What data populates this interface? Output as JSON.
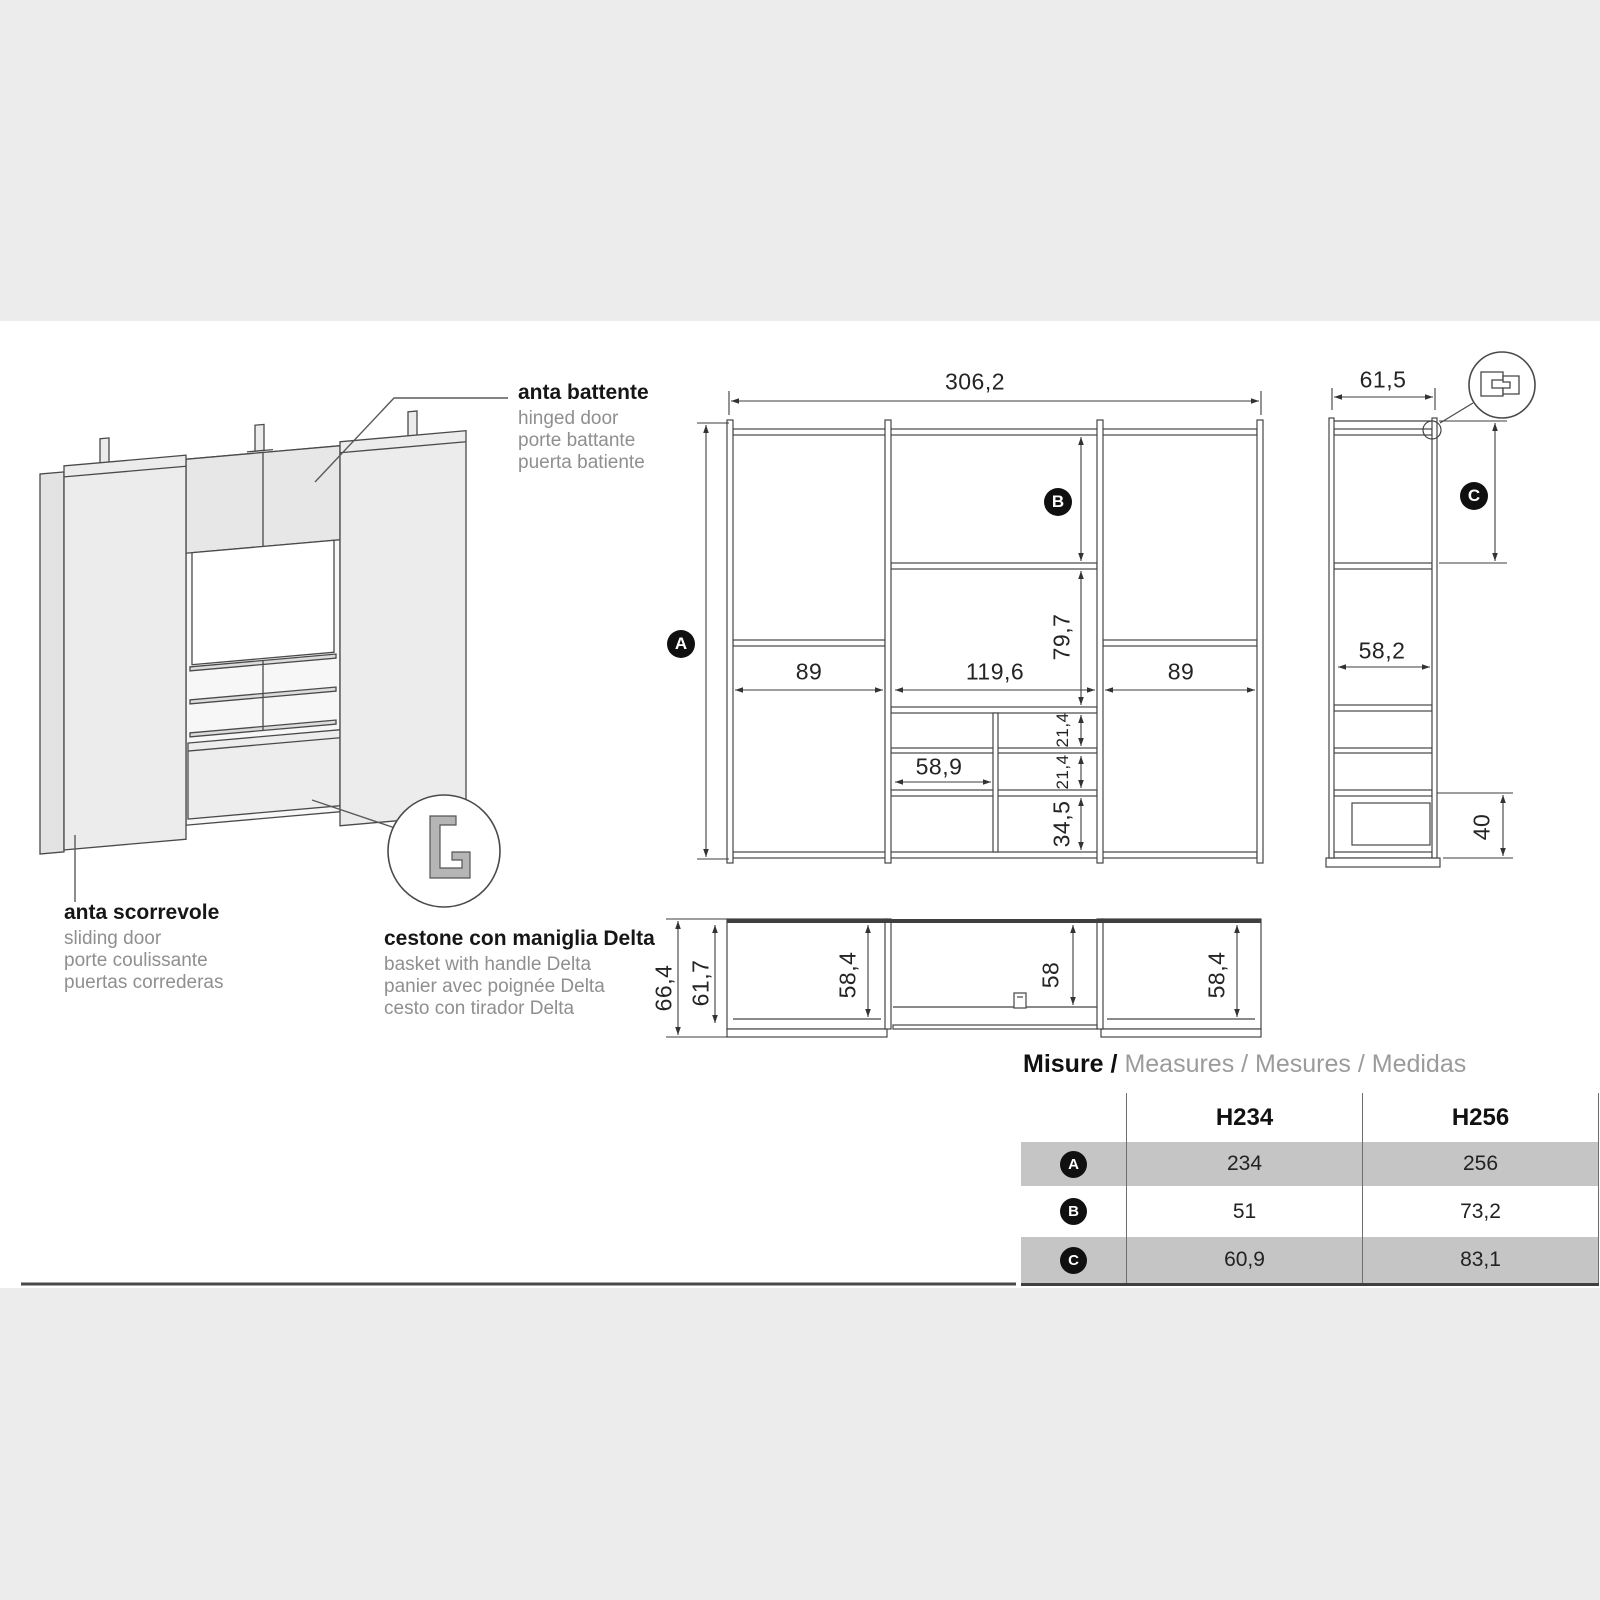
{
  "annotations": {
    "hinged_door": {
      "title": "anta battente",
      "translations": [
        "hinged door",
        "porte battante",
        "puerta batiente"
      ]
    },
    "sliding_door": {
      "title": "anta scorrevole",
      "translations": [
        "sliding door",
        "porte coulissante",
        "puertas correderas"
      ]
    },
    "basket": {
      "title": "cestone con maniglia Delta",
      "translations": [
        "basket with handle Delta",
        "panier avec poignée Delta",
        "cesto con tirador Delta"
      ]
    }
  },
  "front_view": {
    "total_width": "306,2",
    "height_marker": "A",
    "upper_marker": "B",
    "left_width": "89",
    "middle_width": "119,6",
    "right_width": "89",
    "middle_height": "79,7",
    "shelf_gap_1": "21,4",
    "shelf_gap_2": "21,4",
    "bottom_height": "34,5",
    "basket_width": "58,9"
  },
  "side_view": {
    "total_depth": "61,5",
    "depth_marker": "C",
    "shelf_depth": "58,2",
    "drawer_height": "40"
  },
  "plan_view": {
    "total_depth": "66,4",
    "inner_depth": "61,7",
    "left_width": "58,4",
    "middle_width": "58",
    "right_width": "58,4"
  },
  "measures_table": {
    "title": "Misure /",
    "subtitle": "Measures / Mesures / Medidas",
    "columns": [
      "H234",
      "H256"
    ],
    "rows": [
      {
        "label": "A",
        "h234": "234",
        "h256": "256"
      },
      {
        "label": "B",
        "h234": "51",
        "h256": "73,2"
      },
      {
        "label": "C",
        "h234": "60,9",
        "h256": "83,1"
      }
    ]
  }
}
